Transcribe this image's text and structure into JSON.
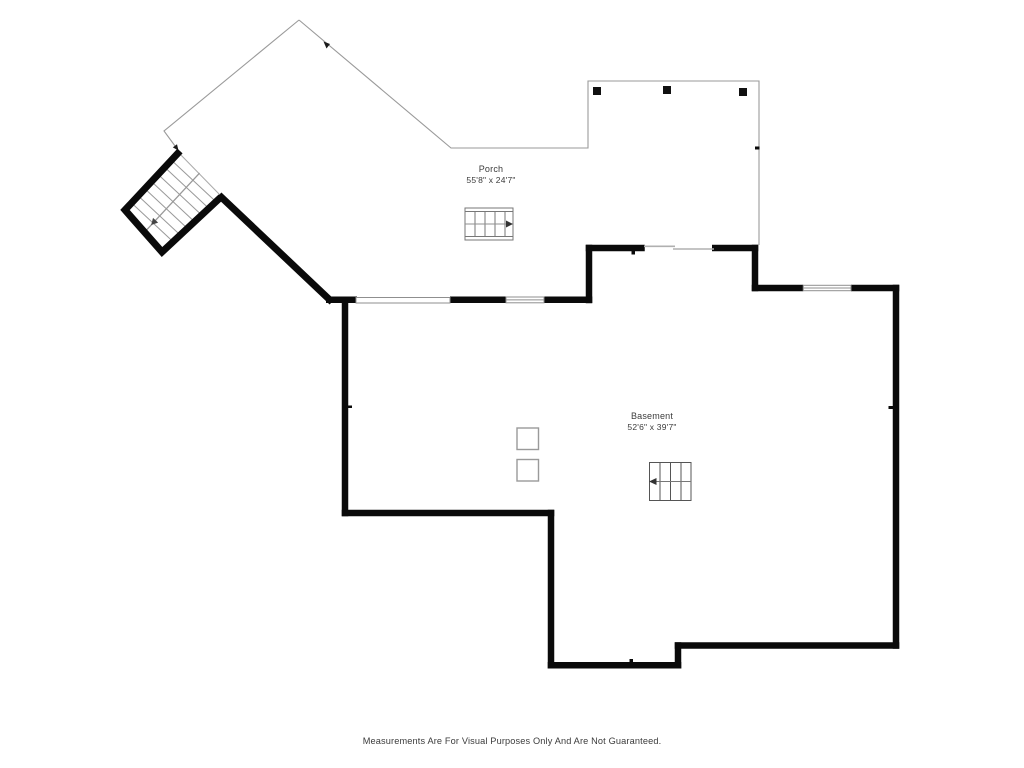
{
  "rooms": [
    {
      "name": "Porch",
      "dimensions": "55'8\" x 24'7\""
    },
    {
      "name": "Basement",
      "dimensions": "52'6\" x 39'7\""
    }
  ],
  "footer": {
    "disclaimer": "Measurements Are For Visual Purposes Only And Are Not Guaranteed."
  },
  "colors": {
    "background": "#ffffff",
    "wall": "#0a0a0a",
    "porch_outline": "#9a9a9a",
    "stair_lines": "#8f8f8f",
    "window_stroke": "#8f8f8f",
    "text": "#3b3b3b"
  }
}
